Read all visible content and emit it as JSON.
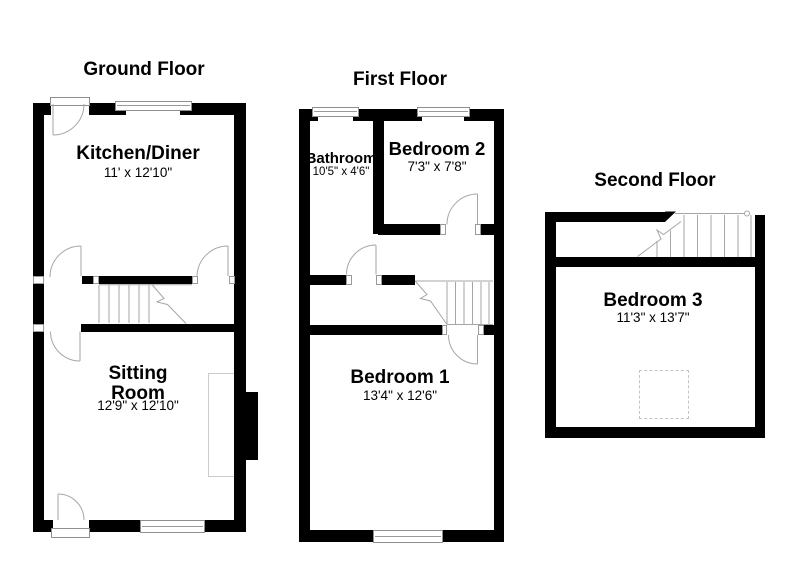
{
  "floors": {
    "ground": {
      "title": "Ground Floor",
      "rooms": {
        "kitchen": {
          "name": "Kitchen/Diner",
          "dims": "11' x 12'10\""
        },
        "sitting": {
          "name": "Sitting Room",
          "dims": "12'9\" x 12'10\""
        }
      }
    },
    "first": {
      "title": "First Floor",
      "rooms": {
        "bathroom": {
          "name": "Bathroom",
          "dims": "10'5\" x 4'6\""
        },
        "bedroom2": {
          "name": "Bedroom 2",
          "dims": "7'3\" x 7'8\""
        },
        "bedroom1": {
          "name": "Bedroom 1",
          "dims": "13'4\" x 12'6\""
        }
      }
    },
    "second": {
      "title": "Second Floor",
      "rooms": {
        "bedroom3": {
          "name": "Bedroom 3",
          "dims": "11'3\" x 13'7\""
        }
      }
    }
  },
  "colors": {
    "wall": "#000000",
    "line": "#a6a6a6",
    "background": "#ffffff"
  }
}
